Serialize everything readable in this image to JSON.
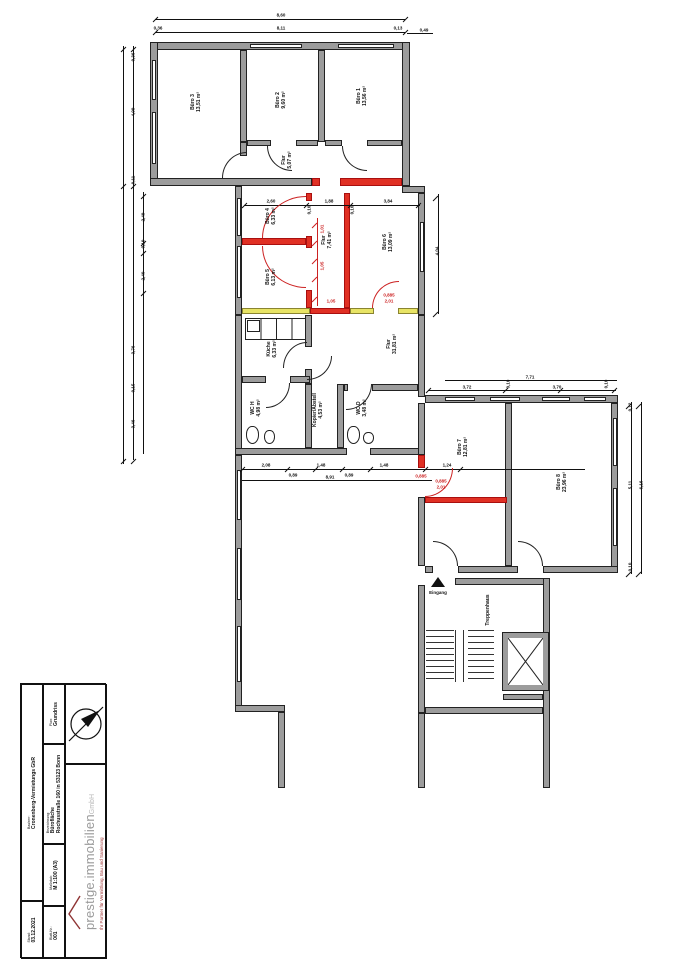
{
  "title_block": {
    "bauherr_label": "Bauherr:",
    "bauherr": "Cronenberg-Vermietungs GbR",
    "stand_label": "Stand:",
    "stand": "03.12.2021",
    "plan_label": "Plan:",
    "plan": "Grundriss",
    "bezeichnung_label": "Bezeichnung:",
    "bezeichnung_line1": "Bürofläche",
    "bezeichnung_line2": "Rochusstraße 160 in 53123 Bonn",
    "massstab_label": "Maßstab:",
    "massstab": "M 1:100 (A3)",
    "blatt_label": "Blatt-Nr.:",
    "blatt": "001"
  },
  "logo": {
    "name": "prestige.immobilien",
    "suffix": "GmbH",
    "tagline": "Ihr Partner für Vermittlung, Bau und Sanierung"
  },
  "plan_labels": {
    "entrance": "Eingang"
  },
  "colors": {
    "wall": "#9c9c9c",
    "new_wall": "#e03024",
    "demolition_wall": "#e8e465",
    "dimension": "#111111",
    "dimension_red": "#cc2222",
    "logo_gray": "#9a9a9a",
    "logo_red": "#a03c3c"
  },
  "rooms": [
    {
      "id": "buero3",
      "name": "Büro 3",
      "area": "13,51 m²",
      "x": 196,
      "y": 102
    },
    {
      "id": "buero2",
      "name": "Büro 2",
      "area": "9,60 m²",
      "x": 281,
      "y": 100
    },
    {
      "id": "buero1",
      "name": "Büro 1",
      "area": "13,56 m²",
      "x": 362,
      "y": 96
    },
    {
      "id": "flur1",
      "name": "Flur",
      "area": "5,07 m²",
      "x": 287,
      "y": 160
    },
    {
      "id": "buero4",
      "name": "Büro 4",
      "area": "6,33 m²",
      "x": 271,
      "y": 216
    },
    {
      "id": "buero5",
      "name": "Büro 5",
      "area": "6,13 m²",
      "x": 271,
      "y": 277
    },
    {
      "id": "flur2",
      "name": "Flur",
      "area": "7,41 m²",
      "x": 327,
      "y": 240
    },
    {
      "id": "buero6",
      "name": "Büro 6",
      "area": "13,09 m²",
      "x": 388,
      "y": 242
    },
    {
      "id": "kueche",
      "name": "Küche",
      "area": "6,33 m²",
      "x": 272,
      "y": 349
    },
    {
      "id": "flur3",
      "name": "Flur",
      "area": "31,81 m²",
      "x": 392,
      "y": 344
    },
    {
      "id": "wc_h",
      "name": "WC H",
      "area": "4,98 m²",
      "x": 256,
      "y": 408
    },
    {
      "id": "kopier",
      "name": "Kopier/Abstell",
      "area": "4,53 m²",
      "x": 318,
      "y": 410
    },
    {
      "id": "wc_d",
      "name": "WC D",
      "area": "3,48 m²",
      "x": 362,
      "y": 408
    },
    {
      "id": "buero7",
      "name": "Büro 7",
      "area": "12,81 m²",
      "x": 463,
      "y": 447
    },
    {
      "id": "buero8",
      "name": "Büro 8",
      "area": "23,96 m²",
      "x": 562,
      "y": 482
    },
    {
      "id": "treppenhaus",
      "name": "Treppenhaus",
      "area": "",
      "x": 488,
      "y": 610
    }
  ],
  "dims": [
    {
      "t": "8,60",
      "x": 281,
      "y": 15
    },
    {
      "t": "0,36",
      "x": 158,
      "y": 28
    },
    {
      "t": "8,11",
      "x": 281,
      "y": 28
    },
    {
      "t": "0,13",
      "x": 398,
      "y": 28
    },
    {
      "t": "0,49",
      "x": 424,
      "y": 30
    },
    {
      "t": "0,36",
      "x": 133,
      "y": 57,
      "r": 1
    },
    {
      "t": "4,09",
      "x": 133,
      "y": 112,
      "r": 1
    },
    {
      "t": "0,11",
      "x": 133,
      "y": 180,
      "r": 1
    },
    {
      "t": "2,49",
      "x": 143,
      "y": 217,
      "r": 1
    },
    {
      "t": "0,10",
      "x": 143,
      "y": 244,
      "r": 1
    },
    {
      "t": "2,40",
      "x": 143,
      "y": 276,
      "r": 1
    },
    {
      "t": "3,76",
      "x": 133,
      "y": 350,
      "r": 1
    },
    {
      "t": "0,15",
      "x": 133,
      "y": 388,
      "r": 1
    },
    {
      "t": "3,46",
      "x": 133,
      "y": 424,
      "r": 1
    },
    {
      "t": "2,60",
      "x": 271,
      "y": 201
    },
    {
      "t": "1,88",
      "x": 329,
      "y": 201
    },
    {
      "t": "3,84",
      "x": 388,
      "y": 201
    },
    {
      "t": "0,10",
      "x": 309,
      "y": 210,
      "r": 1
    },
    {
      "t": "0,10",
      "x": 352,
      "y": 210,
      "r": 1
    },
    {
      "t": "4,04",
      "x": 437,
      "y": 251,
      "r": 1
    },
    {
      "t": "1,01",
      "x": 322,
      "y": 229,
      "r": 1,
      "c": 1
    },
    {
      "t": "1,05",
      "x": 322,
      "y": 266,
      "r": 1,
      "c": 1
    },
    {
      "t": "1,05",
      "x": 331,
      "y": 301,
      "c": 1
    },
    {
      "t": "0,885",
      "x": 389,
      "y": 295,
      "c": 1
    },
    {
      "t": "2,01",
      "x": 389,
      "y": 301,
      "c": 1
    },
    {
      "t": "2,08",
      "x": 266,
      "y": 465
    },
    {
      "t": "0,89",
      "x": 293,
      "y": 475
    },
    {
      "t": "1,48",
      "x": 321,
      "y": 465
    },
    {
      "t": "0,89",
      "x": 349,
      "y": 475
    },
    {
      "t": "1,48",
      "x": 384,
      "y": 465
    },
    {
      "t": "1,24",
      "x": 447,
      "y": 465
    },
    {
      "t": "8,91",
      "x": 330,
      "y": 477
    },
    {
      "t": "0,885",
      "x": 421,
      "y": 476,
      "c": 1
    },
    {
      "t": "0,885",
      "x": 441,
      "y": 481,
      "c": 1
    },
    {
      "t": "2,01",
      "x": 441,
      "y": 487,
      "c": 1
    },
    {
      "t": "7,71",
      "x": 530,
      "y": 377
    },
    {
      "t": "3,72",
      "x": 467,
      "y": 387
    },
    {
      "t": "0,10",
      "x": 508,
      "y": 384,
      "r": 1
    },
    {
      "t": "3,70",
      "x": 557,
      "y": 387
    },
    {
      "t": "0,10",
      "x": 606,
      "y": 384,
      "r": 1
    },
    {
      "t": "0,12",
      "x": 630,
      "y": 407,
      "r": 1
    },
    {
      "t": "5,11",
      "x": 630,
      "y": 485,
      "r": 1
    },
    {
      "t": "6,16",
      "x": 641,
      "y": 485,
      "r": 1
    },
    {
      "t": "0,10",
      "x": 630,
      "y": 567,
      "r": 1
    }
  ]
}
